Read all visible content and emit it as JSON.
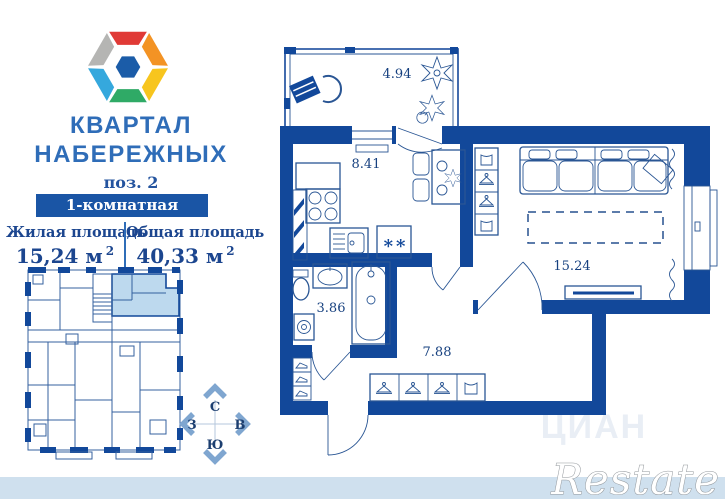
{
  "header": {
    "title_line1": "КВАРТАЛ",
    "title_line2": "НАБЕРЕЖНЫХ",
    "position": "поз. 2",
    "banner": "1-комнатная квартира"
  },
  "areas": {
    "living": {
      "label": "Жилая площадь",
      "value": "15,24 м",
      "sup": "2"
    },
    "total": {
      "label": "Общая площадь",
      "value": "40,33 м",
      "sup": "2"
    }
  },
  "compass": {
    "north": "С",
    "east": "В",
    "south": "Ю",
    "west": "З"
  },
  "floorplan": {
    "rooms": [
      {
        "id": "balcony",
        "area": "4.94"
      },
      {
        "id": "kitchen-living",
        "area": "8.41"
      },
      {
        "id": "bathroom",
        "area": "3.86"
      },
      {
        "id": "hallway",
        "area": "7.88"
      },
      {
        "id": "living-room",
        "area": "15.24"
      }
    ],
    "fridge_mark": "**"
  },
  "watermarks": {
    "restate": "Restate",
    "portal": "ЦИАН"
  },
  "colors": {
    "wall": "#12489a",
    "thin_line": "#2a5694",
    "highlight_unit": "#bdd9ee",
    "title_blue": "#2f6db8",
    "banner_bg": "#1a55a5",
    "text_navy": "#1c468f",
    "footer_bar": "#cfe0ee",
    "compass_arrow": "#7fa6d0",
    "logo": {
      "red": "#e03a36",
      "orange": "#f39324",
      "yellow": "#f7c51e",
      "green": "#2faa66",
      "cyan": "#35a8dd",
      "gray": "#b5b5b3",
      "core": "#1b5ca8"
    }
  }
}
